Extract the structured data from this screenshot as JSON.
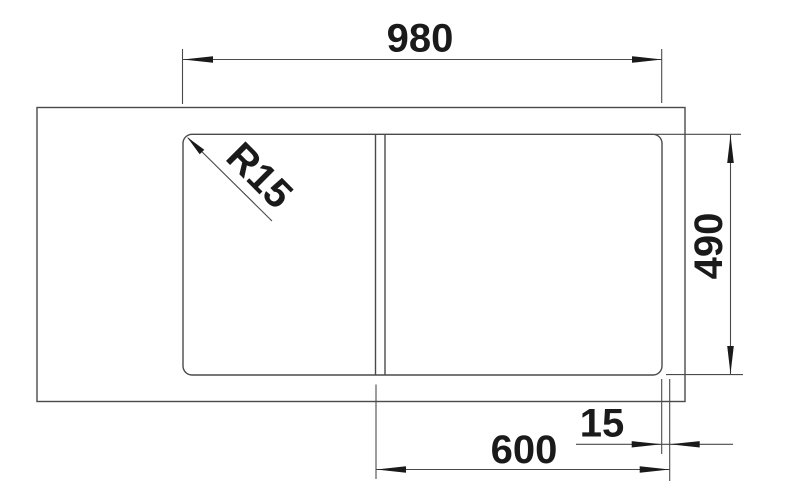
{
  "drawing": {
    "title": "Sink dimension drawing, top view",
    "labels": {
      "overall_width": "980",
      "overall_depth": "490",
      "bowl_width": "600",
      "rim_offset": "15",
      "corner_radius": "R15"
    },
    "colors": {
      "line": "#4a4a4a",
      "accent": "#1a1a1a",
      "background": "#ffffff"
    }
  }
}
